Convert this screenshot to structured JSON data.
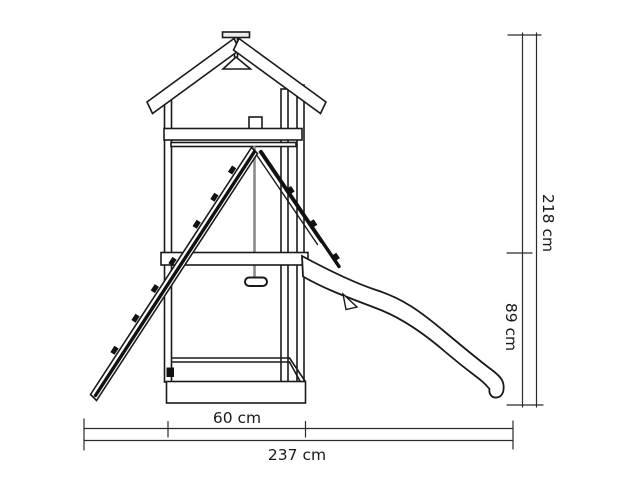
{
  "drawing": {
    "subject_colors": {
      "line": "#1a1a1a",
      "rope": "#8a8a8a",
      "dimension_line": "#2b2b2b",
      "background": "#ffffff"
    }
  },
  "dimensions": {
    "total_height_label": "218 cm",
    "platform_height_label": "89 cm",
    "tower_width_label": "60 cm",
    "total_length_label": "237 cm"
  }
}
